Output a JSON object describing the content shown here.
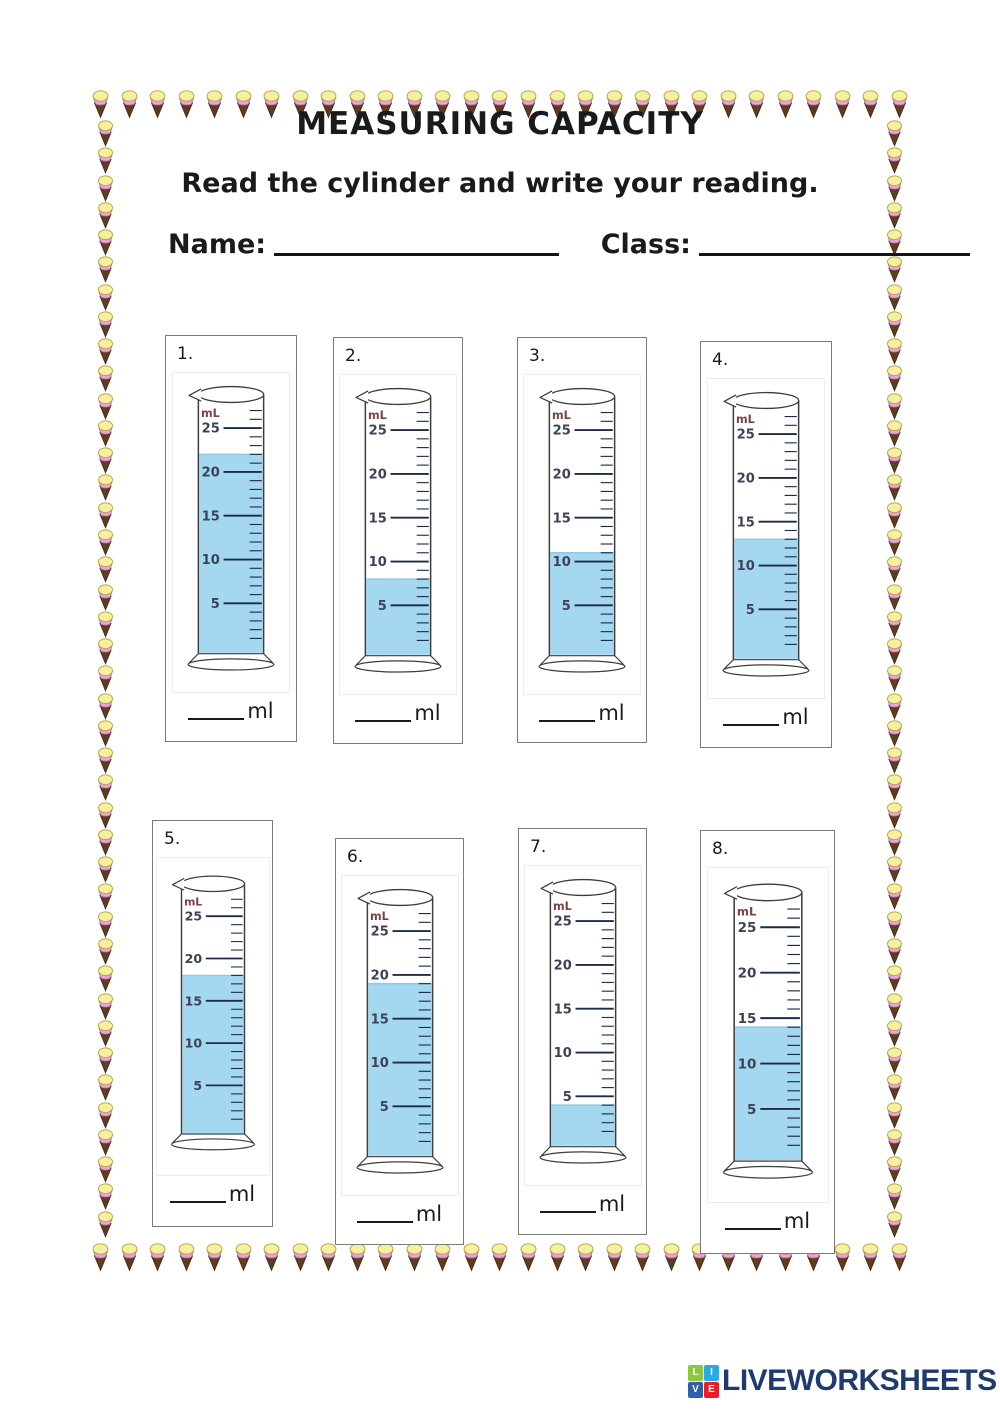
{
  "page": {
    "title": "MEASURING CAPACITY",
    "instruction": "Read the cylinder and write your reading.",
    "name_label": "Name:",
    "class_label": "Class:",
    "unit_label": "ml"
  },
  "scale": {
    "unit_text": "mL",
    "major_labels": [
      25,
      20,
      15,
      10,
      5
    ],
    "minor_step": 1,
    "minor_top": 27
  },
  "chart_data": {
    "type": "table",
    "title": "Measuring cylinder readings",
    "categories": [
      "1.",
      "2.",
      "3.",
      "4.",
      "5.",
      "6.",
      "7.",
      "8."
    ],
    "values": [
      22,
      8,
      11,
      13,
      18,
      19,
      4,
      14
    ],
    "ylabel": "mL",
    "ylim": [
      0,
      25
    ]
  },
  "cylinders": [
    {
      "number": "1.",
      "reading_ml": 22
    },
    {
      "number": "2.",
      "reading_ml": 8
    },
    {
      "number": "3.",
      "reading_ml": 11
    },
    {
      "number": "4.",
      "reading_ml": 13
    },
    {
      "number": "5.",
      "reading_ml": 18
    },
    {
      "number": "6.",
      "reading_ml": 19
    },
    {
      "number": "7.",
      "reading_ml": 4
    },
    {
      "number": "8.",
      "reading_ml": 14
    }
  ],
  "footer": {
    "brand": "LIVEWORKSHEETS",
    "logo_letters": [
      "L",
      "I",
      "V",
      "E"
    ]
  },
  "colors": {
    "water": "#a4d7f0",
    "water_edge": "#8fc9e6",
    "tick": "#1c2b4a",
    "scale_label": "#3e4257",
    "ml_label": "#7d4242",
    "glass_outline": "#3d3d3d",
    "brand_text": "#1e3a6e",
    "logo": {
      "l": "#8dc63f",
      "i": "#29abe2",
      "v": "#2e5fab",
      "e": "#ed1c24"
    },
    "cone": {
      "scoop": "#f5efa0",
      "scoop_stroke": "#b6a23e",
      "band": "#eba3da",
      "band_stroke": "#b06fa6",
      "cone": "#5f3b20",
      "cone_stroke": "#432a15"
    }
  }
}
